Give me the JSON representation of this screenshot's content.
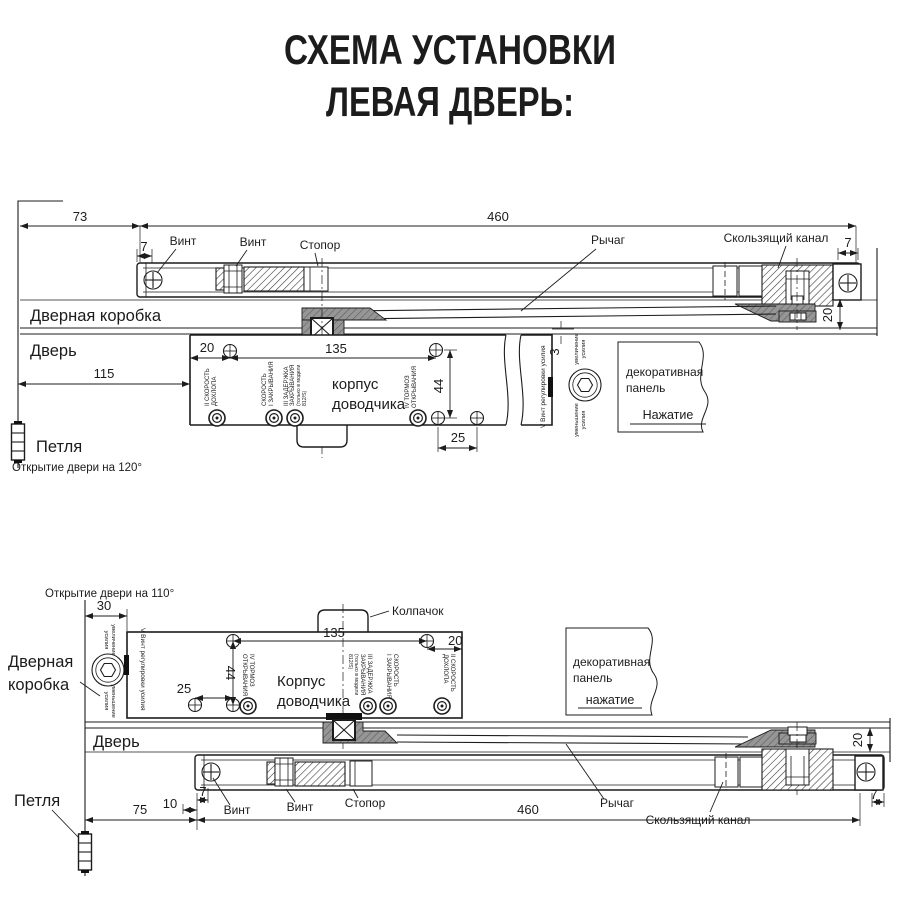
{
  "title": {
    "line1": "СХЕМА УСТАНОВКИ",
    "line2": "ЛЕВАЯ ДВЕРЬ:"
  },
  "colors": {
    "line": "#1c1c1c",
    "gray_fill": "#969696"
  },
  "shared": {
    "vint": "Винт",
    "stopor": "Стопор",
    "rychag": "Рычаг",
    "sliding_channel": "Скользящий канал",
    "hinge": "Петля",
    "panel_line1": "декоративная",
    "panel_line2": "панель",
    "increase_line1": "увеличение",
    "increase_line2": "усилия",
    "decrease_line1": "уменьшение",
    "decrease_line2": "усилия",
    "valve_latch_1": "II СКОРОСТЬ",
    "valve_latch_2": "ДОХЛОПА",
    "valve_close_1": "СКОРОСТЬ",
    "valve_close_2": "I ЗАКРЫВАНИЯ",
    "valve_delay_1": "III ЗАДЕРЖКА",
    "valve_delay_2": "ЗАКРЫВАНИЯ",
    "valve_delay_3": "(только в модели",
    "valve_delay_4": "812/S)",
    "valve_backcheck_1": "IV ТОРМОЗ",
    "valve_backcheck_2": "ОТКРЫВАНИЯ",
    "valve_power": "V Винт регулировки усилия"
  },
  "upper": {
    "frame_label": "Дверная коробка",
    "door_label": "Дверь",
    "opening_note": "Открытие двери на 120°",
    "press_label": "Нажатие",
    "body_line1": "корпус",
    "body_line2": "доводчика",
    "dims": {
      "wall_offset": "73",
      "rail_length": "460",
      "screw_inset": "7",
      "end_inset": "7",
      "rail_drop": "20",
      "hinge_distance": "115",
      "edge_to_screw": "20",
      "screw_span": "135",
      "body_gap": "3",
      "screw_rows": "44",
      "screw_pitch": "25"
    }
  },
  "lower": {
    "frame_label_line1": "Дверная",
    "frame_label_line2": "коробка",
    "door_label": "Дверь",
    "opening_note": "Открытие двери на 110°",
    "cap_label": "Колпачок",
    "press_label": "нажатие",
    "body_line1": "Корпус",
    "body_line2": "доводчика",
    "dims": {
      "frame_offset": "30",
      "rail_length": "460",
      "screw_inset": "7",
      "plate_inset": "10",
      "hinge_distance": "75",
      "edge_to_screw": "20",
      "screw_span": "135",
      "screw_rows": "44",
      "screw_pitch": "25",
      "rail_drop": "20",
      "end_inset": "7"
    }
  }
}
